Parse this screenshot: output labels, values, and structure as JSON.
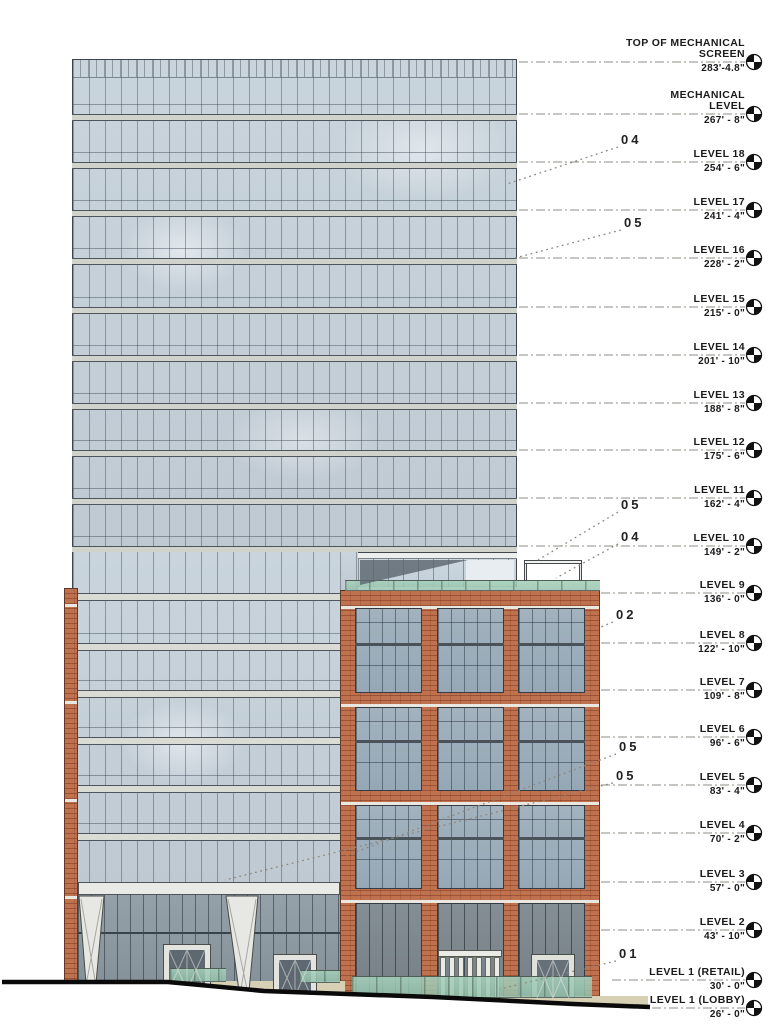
{
  "drawing": {
    "type": "building-elevation",
    "description": "West elevation of 18-story glass tower with brick podium and sloping sidewalk"
  },
  "colors": {
    "glass": "#c4cfd8",
    "podium_window_glass": "#9cadbb",
    "storefront": "#8d99a1",
    "storefront_dark": "#7d878e",
    "brick": "#c0724f",
    "spandrel": "#d0d3cb",
    "trim_white": "#eceded",
    "green_glass": "#a5cfbe",
    "base_tan": "#d8d0b5",
    "outline_dark": "#3f464c",
    "leader_gray": "#8c8c85",
    "text": "#1a1a1a",
    "ground_line": "#0a0a0a"
  },
  "levels": [
    {
      "name": "TOP OF MECHANICAL SCREEN",
      "lines": [
        "TOP OF MECHANICAL",
        "SCREEN"
      ],
      "elevation": "283'-4.8\"",
      "y": 62,
      "sx": 519
    },
    {
      "name": "MECHANICAL LEVEL",
      "lines": [
        "MECHANICAL",
        "LEVEL"
      ],
      "elevation": "267' - 8\"",
      "y": 114,
      "sx": 519
    },
    {
      "name": "LEVEL 18",
      "lines": [
        "LEVEL 18"
      ],
      "elevation": "254' - 6\"",
      "y": 162,
      "sx": 519
    },
    {
      "name": "LEVEL 17",
      "lines": [
        "LEVEL 17"
      ],
      "elevation": "241' - 4\"",
      "y": 210,
      "sx": 519
    },
    {
      "name": "LEVEL 16",
      "lines": [
        "LEVEL 16"
      ],
      "elevation": "228' - 2\"",
      "y": 258,
      "sx": 519
    },
    {
      "name": "LEVEL 15",
      "lines": [
        "LEVEL 15"
      ],
      "elevation": "215' - 0\"",
      "y": 307,
      "sx": 519
    },
    {
      "name": "LEVEL 14",
      "lines": [
        "LEVEL 14"
      ],
      "elevation": "201' - 10\"",
      "y": 355,
      "sx": 519
    },
    {
      "name": "LEVEL 13",
      "lines": [
        "LEVEL 13"
      ],
      "elevation": "188' - 8\"",
      "y": 403,
      "sx": 519
    },
    {
      "name": "LEVEL 12",
      "lines": [
        "LEVEL 12"
      ],
      "elevation": "175' - 6\"",
      "y": 450,
      "sx": 519
    },
    {
      "name": "LEVEL 11",
      "lines": [
        "LEVEL 11"
      ],
      "elevation": "162' - 4\"",
      "y": 498,
      "sx": 519
    },
    {
      "name": "LEVEL 10",
      "lines": [
        "LEVEL 10"
      ],
      "elevation": "149' - 2\"",
      "y": 546,
      "sx": 519
    },
    {
      "name": "LEVEL 9",
      "lines": [
        "LEVEL 9"
      ],
      "elevation": "136' - 0\"",
      "y": 593,
      "sx": 601
    },
    {
      "name": "LEVEL 8",
      "lines": [
        "LEVEL 8"
      ],
      "elevation": "122' - 10\"",
      "y": 643,
      "sx": 601
    },
    {
      "name": "LEVEL 7",
      "lines": [
        "LEVEL 7"
      ],
      "elevation": "109' - 8\"",
      "y": 690,
      "sx": 601
    },
    {
      "name": "LEVEL 6",
      "lines": [
        "LEVEL 6"
      ],
      "elevation": "96' - 6\"",
      "y": 737,
      "sx": 601
    },
    {
      "name": "LEVEL 5",
      "lines": [
        "LEVEL 5"
      ],
      "elevation": "83' - 4\"",
      "y": 785,
      "sx": 601
    },
    {
      "name": "LEVEL 4",
      "lines": [
        "LEVEL 4"
      ],
      "elevation": "70' - 2\"",
      "y": 833,
      "sx": 601
    },
    {
      "name": "LEVEL 3",
      "lines": [
        "LEVEL 3"
      ],
      "elevation": "57' - 0\"",
      "y": 882,
      "sx": 601
    },
    {
      "name": "LEVEL 2",
      "lines": [
        "LEVEL 2"
      ],
      "elevation": "43' - 10\"",
      "y": 930,
      "sx": 601
    },
    {
      "name": "LEVEL 1 (RETAIL)",
      "lines": [
        "LEVEL 1 (RETAIL)"
      ],
      "elevation": "30' - 0\"",
      "y": 980,
      "sx": 612
    },
    {
      "name": "LEVEL 1 (LOBBY)",
      "lines": [
        "LEVEL 1 (LOBBY)"
      ],
      "elevation": "26' - 0\"",
      "y": 1008,
      "sx": 652
    }
  ],
  "callouts": [
    {
      "label": "04",
      "x": 621,
      "y": 133,
      "leader": [
        618,
        147,
        507,
        184
      ]
    },
    {
      "label": "05",
      "x": 624,
      "y": 216,
      "leader": [
        621,
        230,
        515,
        258
      ]
    },
    {
      "label": "05",
      "x": 621,
      "y": 498,
      "leader": [
        618,
        512,
        538,
        560
      ]
    },
    {
      "label": "04",
      "x": 621,
      "y": 530,
      "leader": [
        618,
        544,
        556,
        578
      ]
    },
    {
      "label": "02",
      "x": 616,
      "y": 608,
      "leader": [
        613,
        622,
        601,
        627
      ]
    },
    {
      "label": "05",
      "x": 619,
      "y": 740,
      "leader": [
        616,
        754,
        345,
        856
      ]
    },
    {
      "label": "05",
      "x": 616,
      "y": 769,
      "leader": [
        613,
        783,
        225,
        880
      ]
    },
    {
      "label": "01",
      "x": 619,
      "y": 947,
      "leader": [
        616,
        961,
        500,
        989
      ]
    }
  ]
}
